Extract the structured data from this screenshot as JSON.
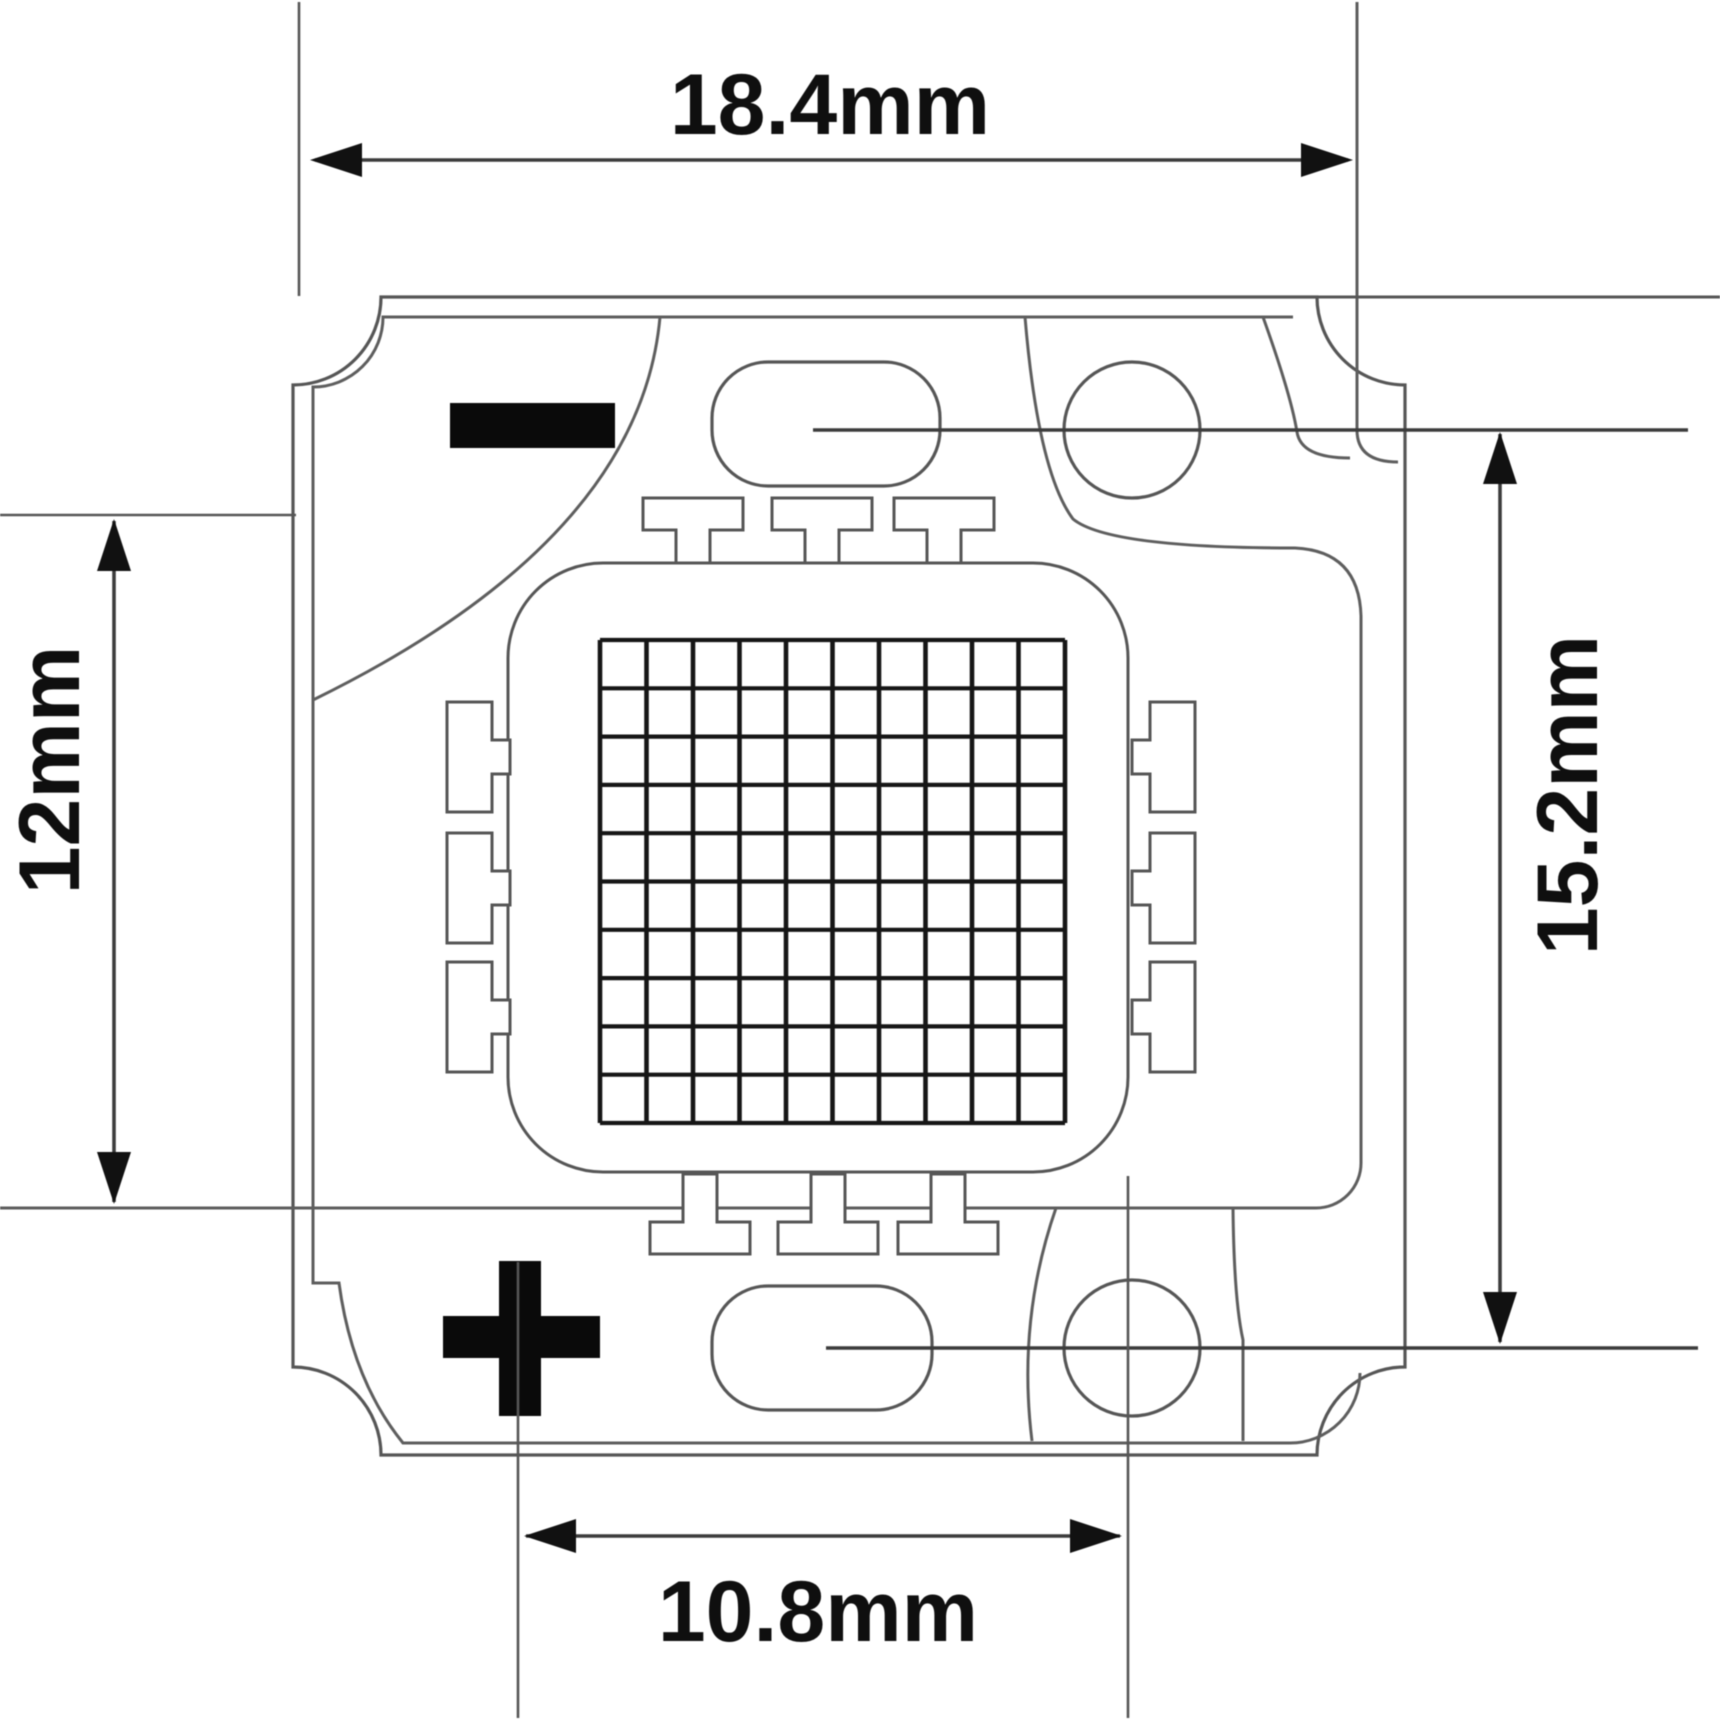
{
  "diagram": {
    "type": "technical-dimension-drawing",
    "subject": "High-power COB LED module, top view",
    "background": "#ffffff",
    "colors": {
      "outline": "#565656",
      "coating_line": "#5e5e5e",
      "grid_line": "#161616",
      "dimension_line": "#3c3c3c",
      "arrow_fill": "#111111",
      "text": "#0f0f0f",
      "mark_fill": "#0a0a0a",
      "fill": "#ffffff"
    },
    "dimensions": [
      {
        "id": "overall-width",
        "label": "18.4mm",
        "edge": "top",
        "orientation": "horizontal"
      },
      {
        "id": "body-height",
        "label": "12mm",
        "edge": "left",
        "orientation": "vertical"
      },
      {
        "id": "pad-pitch-vert",
        "label": "15.2mm",
        "edge": "right",
        "orientation": "vertical"
      },
      {
        "id": "pad-pitch-horz",
        "label": "10.8mm",
        "edge": "bottom",
        "orientation": "horizontal"
      }
    ],
    "polarity_marks": [
      {
        "id": "negative",
        "symbol": "−",
        "position": "top-left"
      },
      {
        "id": "positive",
        "symbol": "+",
        "position": "bottom-left"
      }
    ],
    "led_grid": {
      "rows": 10,
      "cols": 10
    },
    "electrode_tabs": {
      "top": 3,
      "bottom": 3,
      "left": 3,
      "right": 3
    },
    "mounting_holes": 2,
    "solder_pads": 2
  }
}
